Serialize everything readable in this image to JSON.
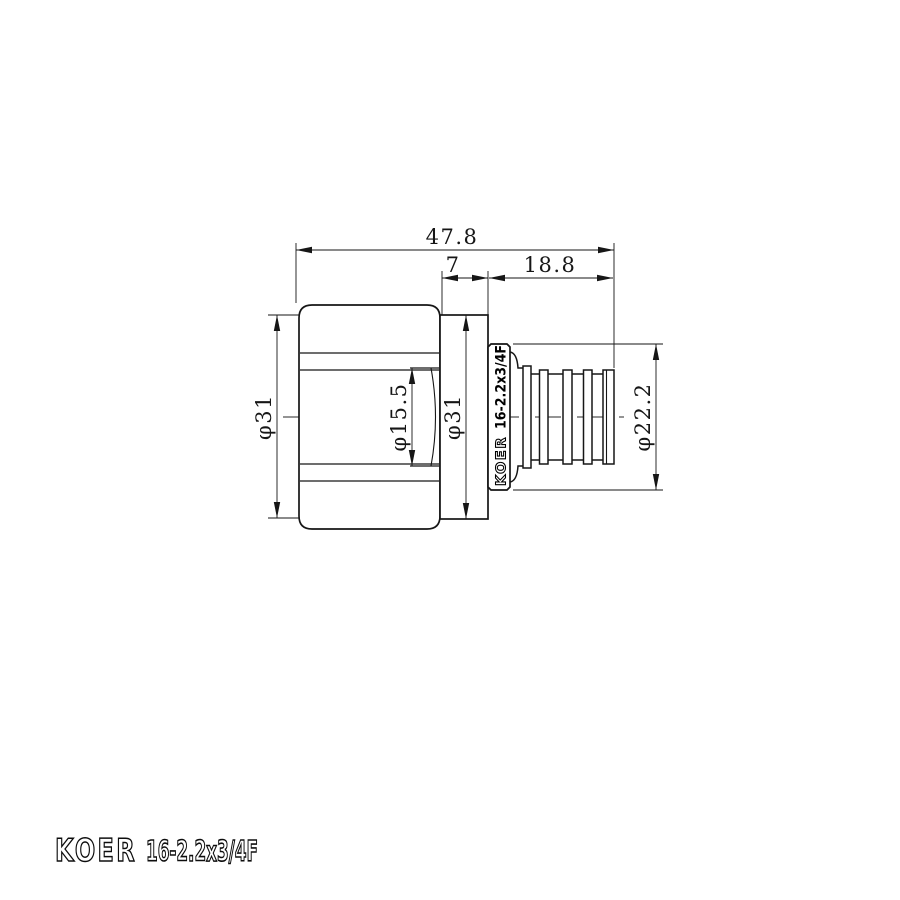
{
  "title": "KOER 16-2.2x3/4F fitting technical drawing",
  "drawing": {
    "dims": {
      "overall_length": "47.8",
      "collar_offset": "7",
      "barb_length": "18.8",
      "hex_flange_diameter": "φ31",
      "bore_diameter": "φ15.5",
      "body_diameter": "φ31",
      "collar_diameter": "φ22.2"
    },
    "collar": {
      "brand": "KOER",
      "model": "16-2.2x3/4F"
    },
    "footer": {
      "brand": "KOER",
      "model": "16-2.2x3/4F"
    },
    "colors": {
      "line": "#161616",
      "background": "#ffffff"
    }
  }
}
